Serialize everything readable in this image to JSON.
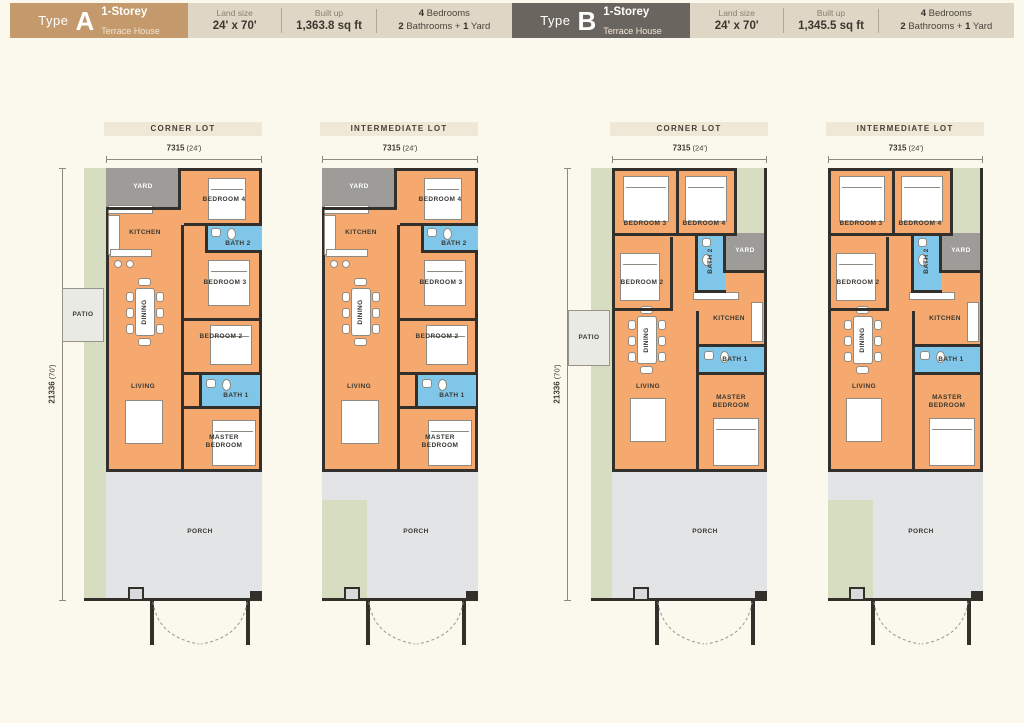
{
  "colors": {
    "background": "#FBF8EE",
    "type_a_badge": "#C4996B",
    "type_b_badge": "#6B6560",
    "info_panel": "#DFD6C5",
    "lot_label_bar": "#EFE8D7",
    "room_orange": "#F6A96E",
    "bath_blue": "#7FC6E8",
    "yard_gray": "#9D9C99",
    "porch_gray": "#E3E4E6",
    "garden_green": "#D7DDC1",
    "patio_gray": "#EAEAE5",
    "wall_dark": "#33302C"
  },
  "headers": [
    {
      "type_word": "Type",
      "letter": "A",
      "storey": "1-Storey",
      "subtype": "Terrace House",
      "land_label": "Land size",
      "land_value": "24' x 70'",
      "built_label": "Built up",
      "built_value": "1,363.8 sq ft",
      "beds_num": "4",
      "beds_word": "Bedrooms",
      "baths_num": "2",
      "baths_word": "Bathrooms",
      "plus_sign": "+",
      "yard_num": "1",
      "yard_word": "Yard"
    },
    {
      "type_word": "Type",
      "letter": "B",
      "storey": "1-Storey",
      "subtype": "Terrace House",
      "land_label": "Land size",
      "land_value": "24' x 70'",
      "built_label": "Built up",
      "built_value": "1,345.5 sq ft",
      "beds_num": "4",
      "beds_word": "Bedrooms",
      "baths_num": "2",
      "baths_word": "Bathrooms",
      "plus_sign": "+",
      "yard_num": "1",
      "yard_word": "Yard"
    }
  ],
  "plans": [
    {
      "lot_type": "CORNER LOT",
      "width_value": "7315",
      "width_unit": "(24')",
      "depth_value": "21336",
      "depth_unit": "(70')",
      "rooms": {
        "yard": "YARD",
        "bedroom4": "BEDROOM 4",
        "kitchen": "KITCHEN",
        "bath2": "BATH 2",
        "bedroom3": "BEDROOM 3",
        "patio": "PATIO",
        "dining": "DINING",
        "bedroom2": "BEDROOM 2",
        "living": "LIVING",
        "bath1": "BATH 1",
        "master": "MASTER BEDROOM",
        "porch": "PORCH"
      }
    },
    {
      "lot_type": "INTERMEDIATE LOT",
      "width_value": "7315",
      "width_unit": "(24')",
      "rooms": {
        "yard": "YARD",
        "bedroom4": "BEDROOM 4",
        "kitchen": "KITCHEN",
        "bath2": "BATH 2",
        "bedroom3": "BEDROOM 3",
        "dining": "DINING",
        "bedroom2": "BEDROOM 2",
        "living": "LIVING",
        "bath1": "BATH 1",
        "master": "MASTER BEDROOM",
        "porch": "PORCH"
      }
    },
    {
      "lot_type": "CORNER LOT",
      "width_value": "7315",
      "width_unit": "(24')",
      "depth_value": "21336",
      "depth_unit": "(70')",
      "rooms": {
        "bedroom3": "BEDROOM 3",
        "bedroom4": "BEDROOM 4",
        "yard": "YARD",
        "bath2": "BATH 2",
        "bedroom2": "BEDROOM 2",
        "kitchen": "KITCHEN",
        "patio": "PATIO",
        "dining": "DINING",
        "bath1": "BATH 1",
        "living": "LIVING",
        "master": "MASTER BEDROOM",
        "porch": "PORCH"
      }
    },
    {
      "lot_type": "INTERMEDIATE LOT",
      "width_value": "7315",
      "width_unit": "(24')",
      "rooms": {
        "bedroom3": "BEDROOM 3",
        "bedroom4": "BEDROOM 4",
        "yard": "YARD",
        "bath2": "BATH 2",
        "bedroom2": "BEDROOM 2",
        "kitchen": "KITCHEN",
        "dining": "DINING",
        "bath1": "BATH 1",
        "living": "LIVING",
        "master": "MASTER BEDROOM",
        "porch": "PORCH"
      }
    }
  ]
}
